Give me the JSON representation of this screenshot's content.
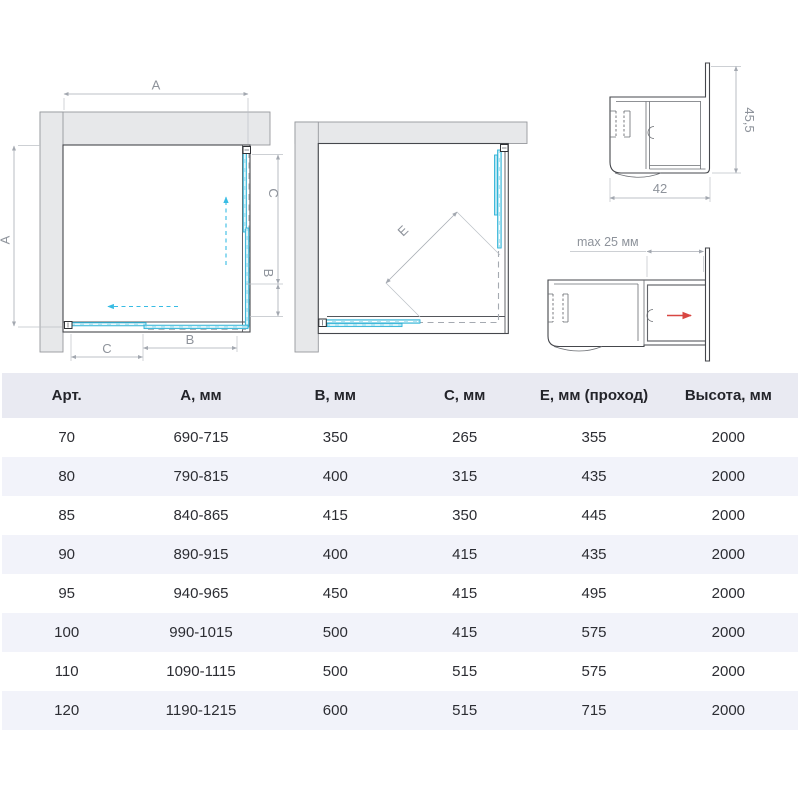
{
  "diagrams": {
    "plan_closed": {
      "dim_a_top": "A",
      "dim_a_left": "A",
      "dim_c_right": "C",
      "dim_b_right": "B",
      "dim_b_bottom": "B",
      "dim_c_bottom": "C"
    },
    "plan_open": {
      "dim_e": "E"
    },
    "profile_corner": {
      "height": "45,5",
      "width": "42"
    },
    "profile_adjust": {
      "label": "max 25 мм"
    }
  },
  "table": {
    "headers": [
      "Арт.",
      "А, мм",
      "В, мм",
      "С, мм",
      "Е, мм (проход)",
      "Высота, мм"
    ],
    "rows": [
      [
        "70",
        "690-715",
        "350",
        "265",
        "355",
        "2000"
      ],
      [
        "80",
        "790-815",
        "400",
        "315",
        "435",
        "2000"
      ],
      [
        "85",
        "840-865",
        "415",
        "350",
        "445",
        "2000"
      ],
      [
        "90",
        "890-915",
        "400",
        "415",
        "435",
        "2000"
      ],
      [
        "95",
        "940-965",
        "450",
        "415",
        "495",
        "2000"
      ],
      [
        "100",
        "990-1015",
        "500",
        "415",
        "575",
        "2000"
      ],
      [
        "110",
        "1090-1115",
        "500",
        "515",
        "575",
        "2000"
      ],
      [
        "120",
        "1190-1215",
        "600",
        "515",
        "715",
        "2000"
      ]
    ]
  },
  "colors": {
    "glass_blue": "#b5e4f1",
    "glass_blue_edge": "#2eb3d7",
    "arrow_cyan": "#38bce4",
    "arrow_red": "#d84742",
    "header_bg": "#e9eaf2",
    "stripe_bg": "#f2f3fa"
  }
}
